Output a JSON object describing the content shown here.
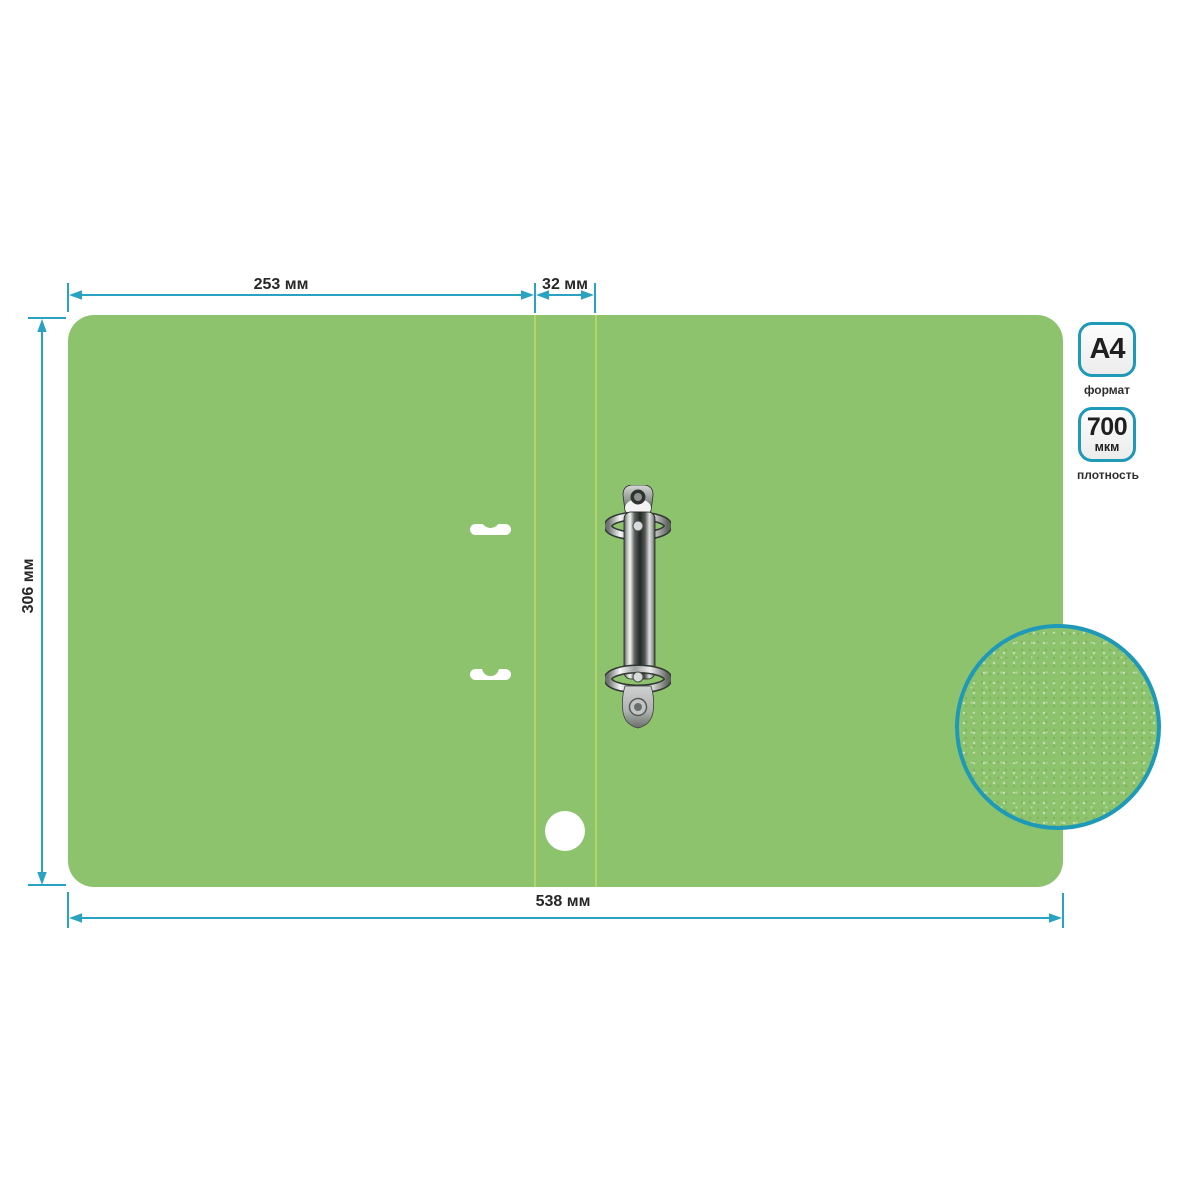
{
  "dimensions": {
    "cover_width": "253 мм",
    "spine_width": "32 мм",
    "sheet_height": "306 мм",
    "total_width": "538 мм"
  },
  "badges": [
    {
      "value": "A4",
      "caption": "формат"
    },
    {
      "value": "700",
      "unit": "мкм",
      "caption": "плотность"
    }
  ],
  "colors": {
    "folder_green": "#8EC36E",
    "fold_line_green": "#B5D36B",
    "dimension_teal": "#2AA2C2",
    "badge_border_teal": "#1E99B7",
    "label_text": "#272727",
    "cutout_white": "#ffffff"
  }
}
